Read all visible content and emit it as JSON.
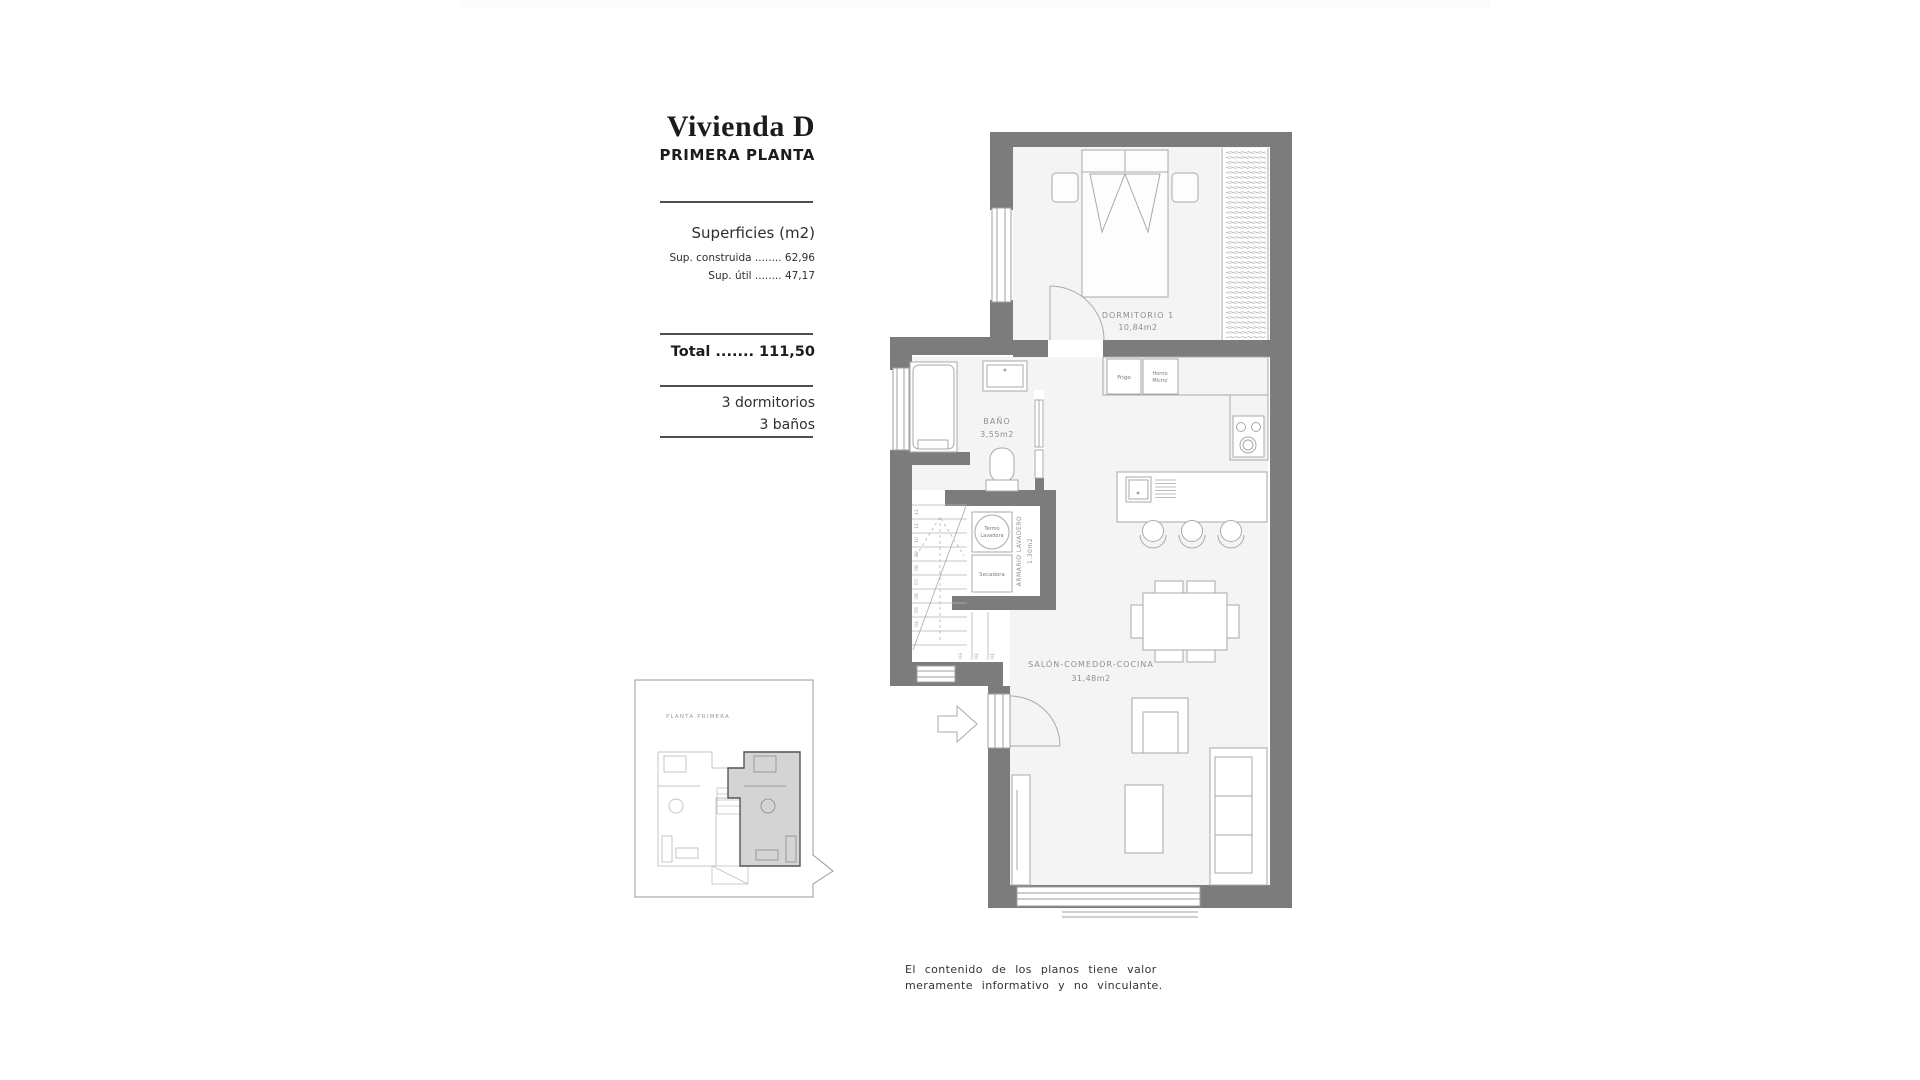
{
  "panel": {
    "title": "Vivienda D",
    "subtitle": "PRIMERA PLANTA",
    "surfaces_heading": "Superficies (m2)",
    "line_construida": "Sup. construida ........ 62,96",
    "line_util": "Sup. útil ........ 47,17",
    "total_line": "Total ....... 111,50",
    "feature_dormitorios": "3 dormitorios",
    "feature_banos": "3 baños"
  },
  "plan": {
    "rooms": {
      "dormitorio": {
        "name": "DORMITORIO 1",
        "area": "10,84m2"
      },
      "bano": {
        "name": "BAÑO",
        "area": "3,55m2"
      },
      "armario": {
        "name": "ARMARIO LAVADERO",
        "area": "1,30m2"
      },
      "salon": {
        "name": "SALÓN-COMEDOR-COCINA",
        "area": "31,48m2"
      }
    },
    "appliances": {
      "frigo": "Frigo",
      "horno_line1": "Horno",
      "horno_line2": "Micro/",
      "termo_line1": "Termo",
      "termo_line2": "Lavadora",
      "secadora": "Secadora"
    },
    "stairs": {
      "steps": [
        "01",
        "02",
        "03",
        "04",
        "05",
        "06",
        "07",
        "08",
        "09",
        "10",
        "11",
        "12"
      ]
    }
  },
  "minimap": {
    "label": "PLANTA PRIMERA"
  },
  "disclaimer": {
    "line1": "El contenido de los planos tiene valor",
    "line2": "meramente informativo y no vinculante."
  },
  "colors": {
    "wall": "#7c7c7c",
    "room_fill": "#f4f4f5",
    "line": "#a9a9a9",
    "label": "#8f8f8f"
  }
}
